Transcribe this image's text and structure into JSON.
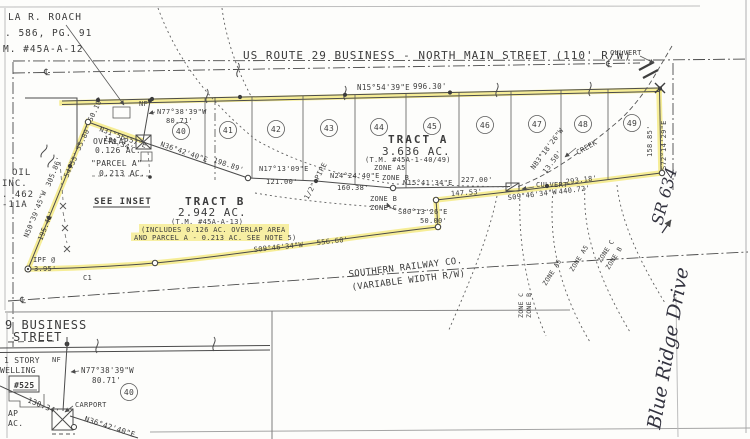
{
  "colors": {
    "highlight": "#f4e87d",
    "ink": "#3c3c3c"
  },
  "symbols": {
    "centerline": "℄"
  },
  "owner_block": {
    "line1": "LA R. ROACH",
    "line2": ". 586, PG. 91",
    "line3": "M. #45A-A-12"
  },
  "street": {
    "name": "US ROUTE 29 BUSINESS - NORTH MAIN STREET (110' R/W)",
    "bearing": "N15°54'39\"E",
    "distance": "996.30'"
  },
  "labels": {
    "culvert": "CULVERT",
    "creek": "CREEK",
    "nf": "NF",
    "see_inset": "SEE INSET",
    "pipe": "1/2\" PIPE",
    "ipf": "IPF @",
    "ipf_dist": "3.95'",
    "c1": "C1",
    "zone_a5": "ZONE A5",
    "zone_b": "ZONE B",
    "zone_c": "ZONE C"
  },
  "tract_a": {
    "name": "TRACT A",
    "area": "3.636 AC.",
    "tm": "(T.M. #45A-1-40/49)"
  },
  "tract_b": {
    "name": "TRACT B",
    "area": "2.942 AC.",
    "tm": "(T.M. #45A-A-13)",
    "note1": "(INCLUDES 0.126 AC. OVERLAP AREA",
    "note2": "AND PARCEL A - 0.213 AC. SEE NOTE 5)"
  },
  "overlap": {
    "name": "OVERLAP",
    "area": "0.126 AC."
  },
  "parcel_a": {
    "name": "\"PARCEL A\"",
    "area": "0.213 AC."
  },
  "lots": [
    "40",
    "41",
    "42",
    "43",
    "44",
    "45",
    "46",
    "47",
    "48",
    "49"
  ],
  "bearings": {
    "road_front": {
      "bearing": "N77°38'39\"W",
      "distance": "80.71'"
    },
    "overlap_diag": {
      "bearing": "N31°56'57\"E",
      "distance": "130.34'"
    },
    "rear1": {
      "bearing": "N36°42'40\"E",
      "distance": "198.89'"
    },
    "rear2": {
      "bearing": "N17°13'09\"E",
      "distance": "121.00'"
    },
    "rear3": {
      "bearing": "N24°24'40\"E",
      "distance": "160.38'"
    },
    "rear4": {
      "bearing": "N15°41'34\"E",
      "distance": "227.00'"
    },
    "rear5": {
      "distance": "147.53'"
    },
    "creek_jog": {
      "bearing": "N83°18'26\"W",
      "distance": "13.50'"
    },
    "rear_east": {
      "bearing": "S09°46'34\"W",
      "distance": "440.72'",
      "distance2": "293.18'"
    },
    "jog_south": {
      "bearing": "S80°13'26\"E",
      "distance": "50.00'"
    },
    "south": {
      "bearing": "S09°46'34\"W",
      "distance": "556.60'"
    },
    "west": {
      "bearing": "N50°39'45\"W",
      "distance": "195.41'",
      "distance2": "305.86'"
    },
    "west_ties": {
      "d1": "54.55'",
      "d2": "55.80'",
      "d3": "50.10'"
    },
    "east_side": {
      "bearing": "S72°14'29\"E",
      "distance": "158.85'"
    }
  },
  "railway": {
    "line1": "SOUTHERN RAILWAY CO.",
    "line2": "(VARIABLE WIDTH R/W)"
  },
  "adjoiner_left": {
    "line1": "OIL",
    "line2": "INC.",
    "line3": ". 462",
    "line4": "-11A"
  },
  "handwriting": {
    "road": "Blue Ridge Drive",
    "route": "SR 634"
  },
  "inset": {
    "street1": "9 BUSINESS",
    "street2": "STREET",
    "nf": "NF",
    "story": "1 STORY",
    "dwelling": "WELLING",
    "house": "#525",
    "carport": "CARPORT",
    "lot": "40",
    "dist130": "130.34'",
    "bearing1": {
      "bearing": "N77°38'39\"W",
      "distance": "80.71'"
    },
    "bearing2": {
      "bearing": "N36°42'40\"E"
    },
    "frag1": "AP",
    "frag2": "AC."
  }
}
